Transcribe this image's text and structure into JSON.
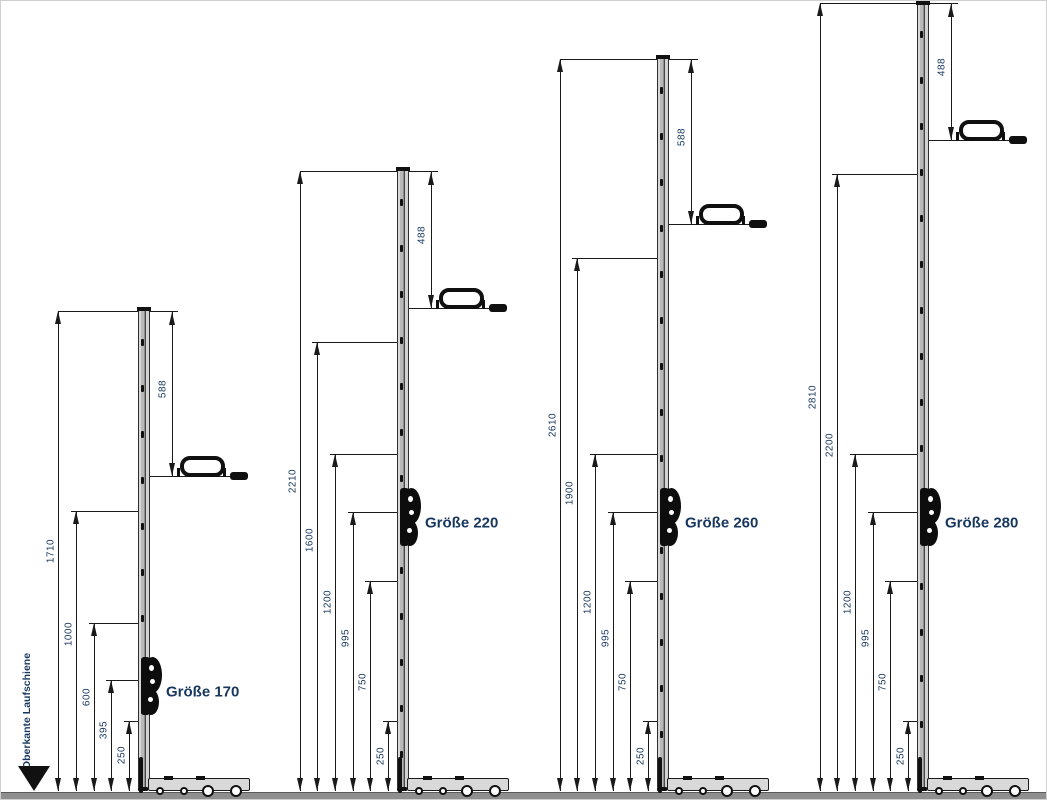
{
  "drawing": {
    "kind": "technical dimension drawing of sliding-door espagnolette gear sizes",
    "unit": "mm"
  },
  "left_marker": {
    "label": "Oberkante Laufschiene"
  },
  "colors": {
    "label_text": "#17375E",
    "line_ink": "#1a1a1a",
    "rail_fill": "#b9b9b9",
    "floor_bar": "#8f8f8f"
  },
  "groups": [
    {
      "label": "Größe 170",
      "dims_from_bottom_mm": [
        1710,
        1000,
        600,
        395,
        250
      ],
      "dim_from_top_mm": 588
    },
    {
      "label": "Größe 220",
      "dims_from_bottom_mm": [
        2210,
        1600,
        1200,
        995,
        750,
        250
      ],
      "dim_from_top_mm": 488
    },
    {
      "label": "Größe 260",
      "dims_from_bottom_mm": [
        2610,
        1900,
        1200,
        995,
        750,
        250
      ],
      "dim_from_top_mm": 588
    },
    {
      "label": "Größe 280",
      "dims_from_bottom_mm": [
        2810,
        2200,
        1200,
        995,
        750,
        250
      ],
      "dim_from_top_mm": 488
    }
  ]
}
